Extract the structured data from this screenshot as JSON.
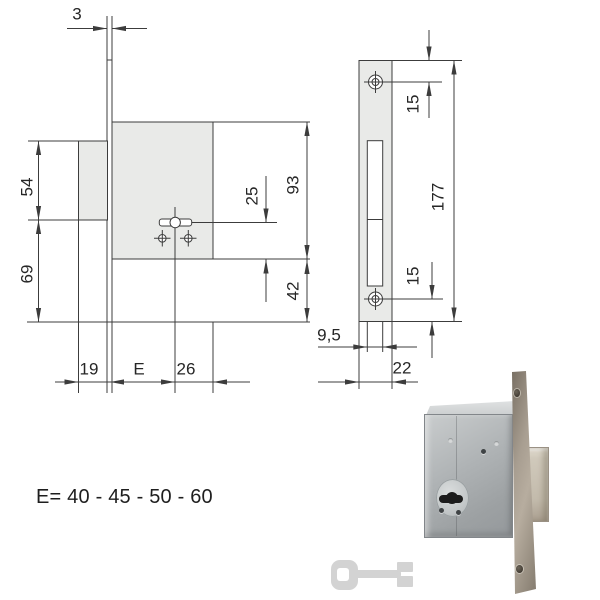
{
  "colors": {
    "line": "#3c3c3c",
    "drawing_fill": "#e9eae8",
    "dim_text": "#262626",
    "caption_text": "#1e1e1e",
    "paper": "#ffffff"
  },
  "drawing": {
    "side_view": {
      "faceplate_thickness": "3",
      "box_top_to_key_axis": "54",
      "key_axis_to_plate_bottom": "69",
      "key_axis_to_case_bottom": "25",
      "case_height": "93",
      "case_bottom_to_plate_bottom": "42",
      "box_depth": "19",
      "backset": "E",
      "key_axis_to_case_back": "26"
    },
    "front_view": {
      "plate_top_to_hole": "15",
      "plate_height": "177",
      "hole_to_plate_bottom": "15",
      "slot_width": "9,5",
      "plate_width": "22"
    }
  },
  "caption": {
    "backset_options": "E= 40 - 45 - 50 - 60"
  }
}
